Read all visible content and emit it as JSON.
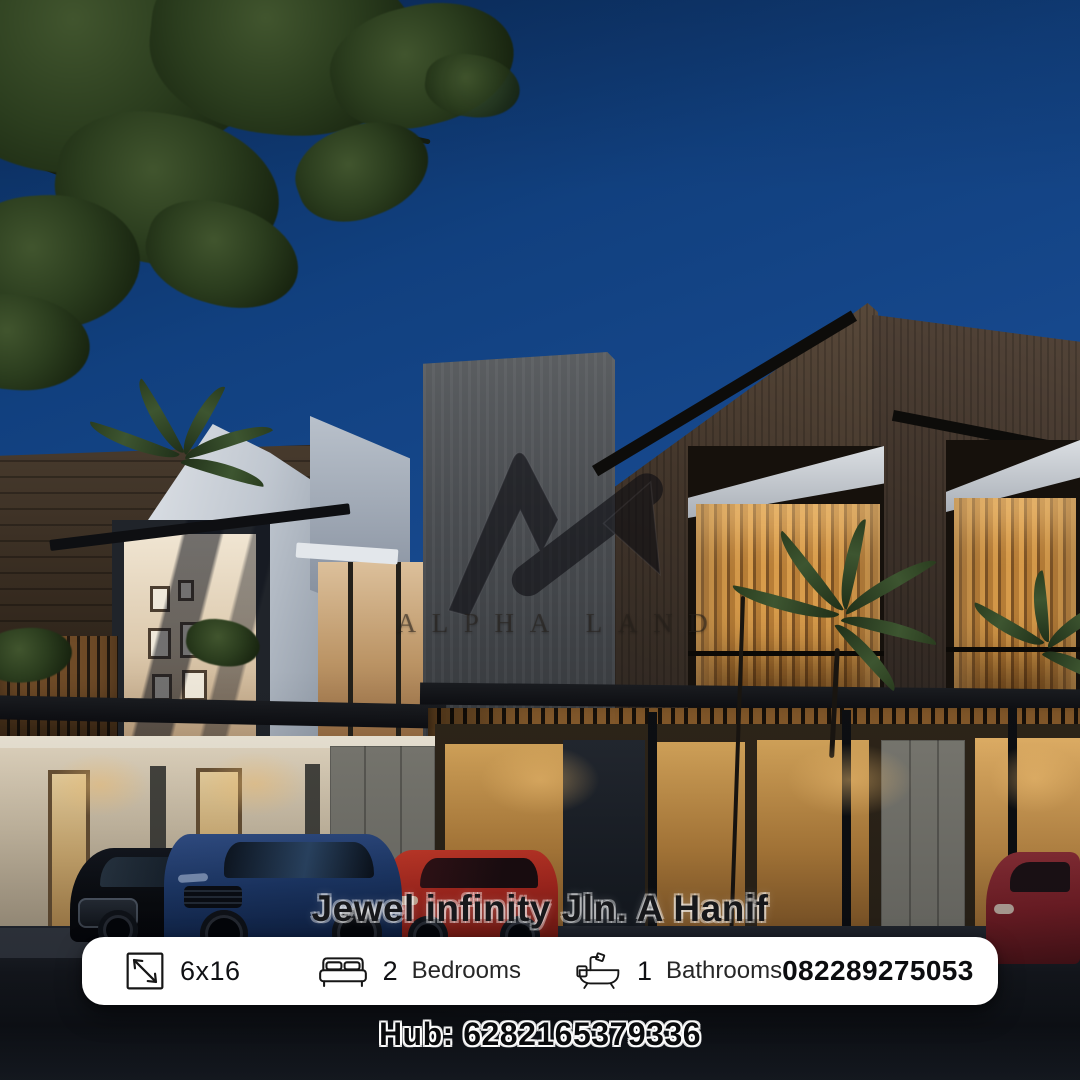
{
  "brand": {
    "name": "ALPHA LAND",
    "logo_icon": "alpha-land-logo-icon"
  },
  "listing": {
    "title": "Jewel infinity Jln. A Hanif",
    "size_value": "6x16",
    "bedrooms_count": "2",
    "bedrooms_label": "Bedrooms",
    "bathrooms_count": "1",
    "bathrooms_label": "Bathrooms",
    "phone": "082289275053",
    "hub": "Hub: 6282165379336"
  },
  "icons": {
    "size": "dimensions-icon",
    "bedrooms": "bed-icon",
    "bathrooms": "bathtub-icon"
  },
  "colors": {
    "sky_blue": "#17498e",
    "bar_background": "#ffffff",
    "text_dark": "#101114",
    "warm_wood": "#c3873c",
    "roof_dark": "#3f332a",
    "car_blue": "#1e3b6e",
    "car_red": "#b3291f"
  },
  "scene": {
    "description": "Modern two-storey townhouse complex at dusk with warm lit interiors, palm trees, parked cars and street in foreground"
  }
}
